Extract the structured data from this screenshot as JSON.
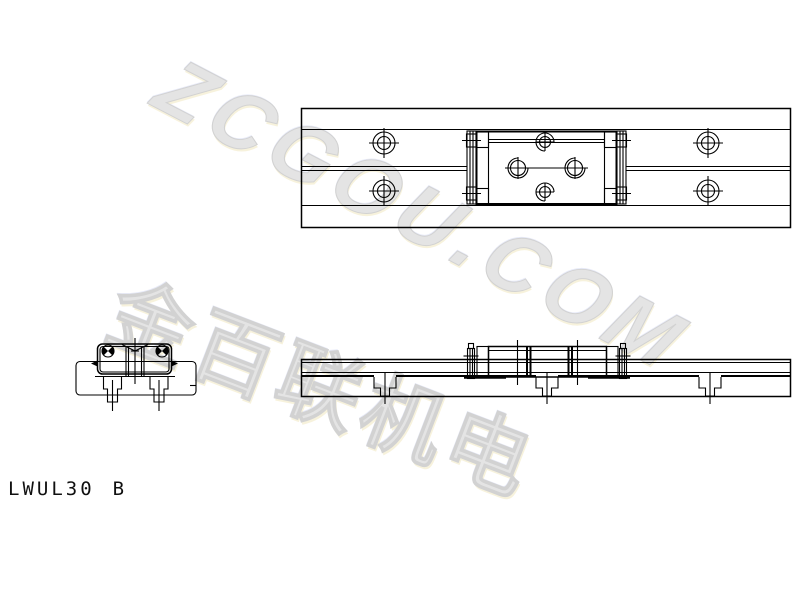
{
  "canvas": {
    "width": 800,
    "height": 600,
    "background": "#ffffff",
    "line_color": "#000000"
  },
  "title_block": {
    "model": "LWUL30",
    "size_code": "B"
  },
  "watermark": {
    "brand_text": "ZCGOU.COM",
    "company_text": "金百联机电",
    "color": "#e4e4e4"
  },
  "views": {
    "plan_view": {
      "label": "plan view of rail with carriage",
      "rail_mount_holes": [
        [
          384,
          143
        ],
        [
          384,
          191
        ],
        [
          708,
          143
        ],
        [
          708,
          191
        ]
      ],
      "carriage_thread_holes": [
        [
          545,
          142
        ],
        [
          545,
          192
        ]
      ],
      "carriage_center_holes": [
        [
          518,
          168
        ],
        [
          575,
          168
        ]
      ]
    },
    "side_view": {
      "label": "side elevation of rail with carriage",
      "counterbore_hole_centers_x": [
        385,
        547,
        710
      ]
    },
    "end_view": {
      "label": "end cross-section view",
      "bolt_hole_centers_x": [
        112.5,
        159
      ]
    }
  }
}
